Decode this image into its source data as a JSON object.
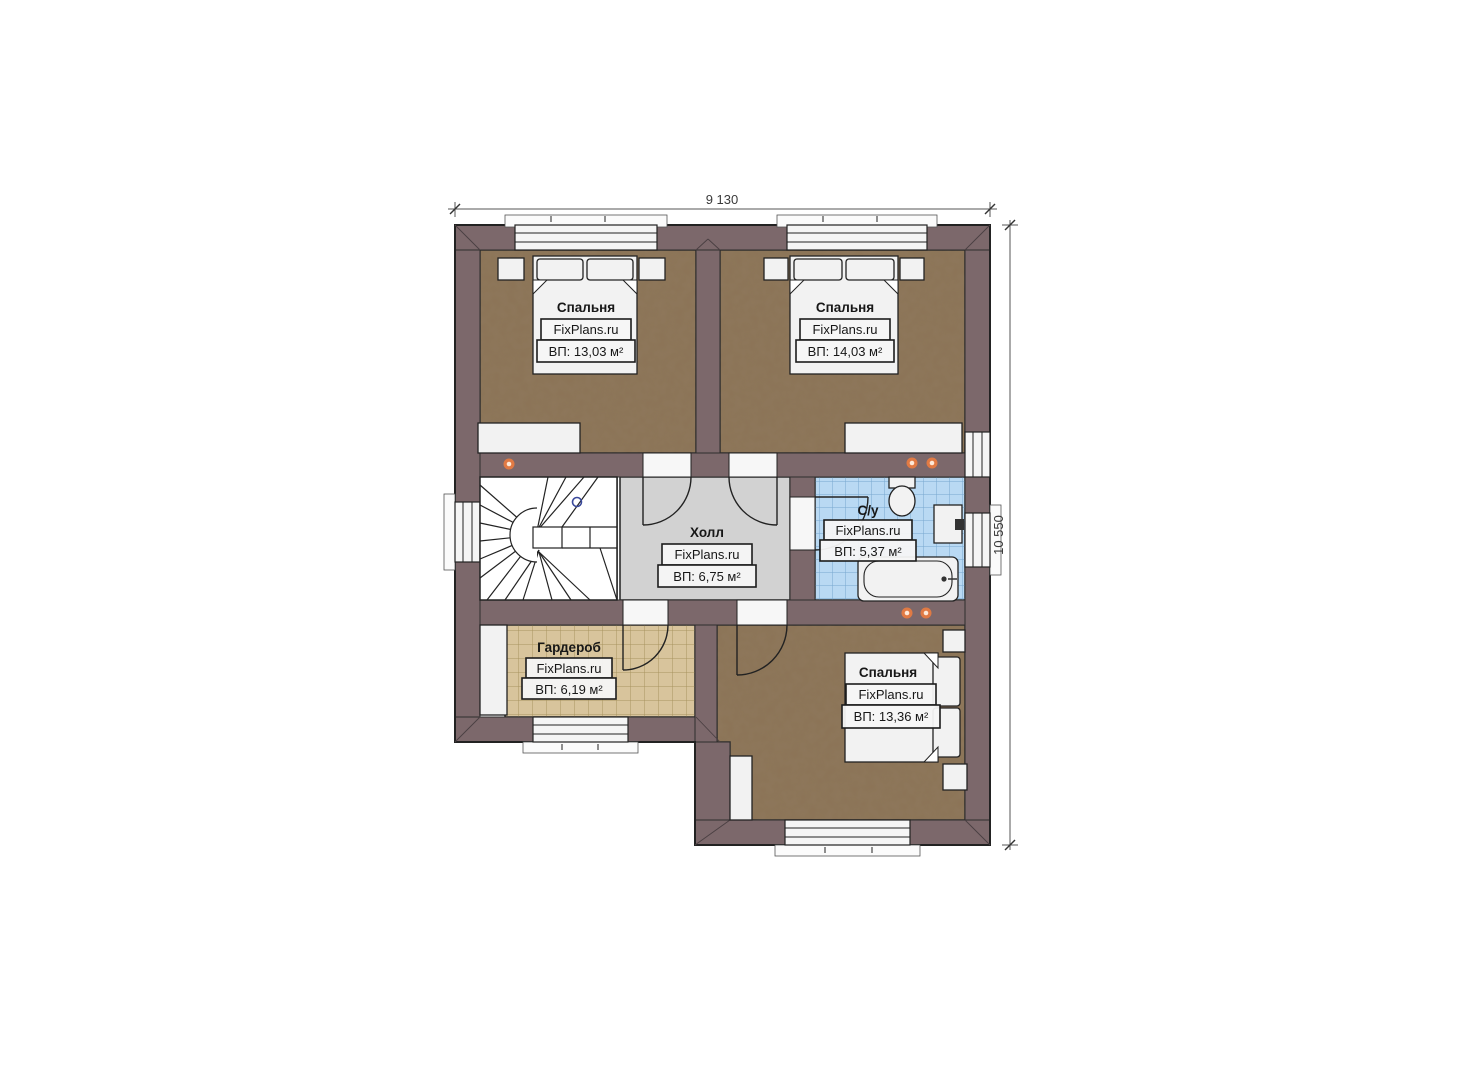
{
  "plan": {
    "dimensions": {
      "width_label": "9 130",
      "height_label": "10 550"
    },
    "rooms": {
      "bedroom1": {
        "name": "Спальня",
        "watermark": "FixPlans.ru",
        "area": "ВП: 13,03 м²"
      },
      "bedroom2": {
        "name": "Спальня",
        "watermark": "FixPlans.ru",
        "area": "ВП: 14,03 м²"
      },
      "hall": {
        "name": "Холл",
        "watermark": "FixPlans.ru",
        "area": "ВП: 6,75 м²"
      },
      "bathroom": {
        "name": "С/у",
        "watermark": "FixPlans.ru",
        "area": "ВП: 5,37 м²"
      },
      "wardrobe": {
        "name": "Гардероб",
        "watermark": "FixPlans.ru",
        "area": "ВП: 6,19 м²"
      },
      "bedroom3": {
        "name": "Спальня",
        "watermark": "FixPlans.ru",
        "area": "ВП: 13,36 м²"
      }
    },
    "colors": {
      "wall": "#7c686b",
      "bedroom_floor": "#8b7356",
      "hall_floor": "#d2d2d2",
      "bath_floor": "#b9d9f3",
      "bath_tile_line": "#78a7cf",
      "wardrobe_floor": "#d8c49c",
      "wardrobe_tile_line": "#a8935f",
      "fixture_white": "#f2f2f2",
      "accent_dot": "#e07a44",
      "outline": "#2b2b2b"
    }
  }
}
